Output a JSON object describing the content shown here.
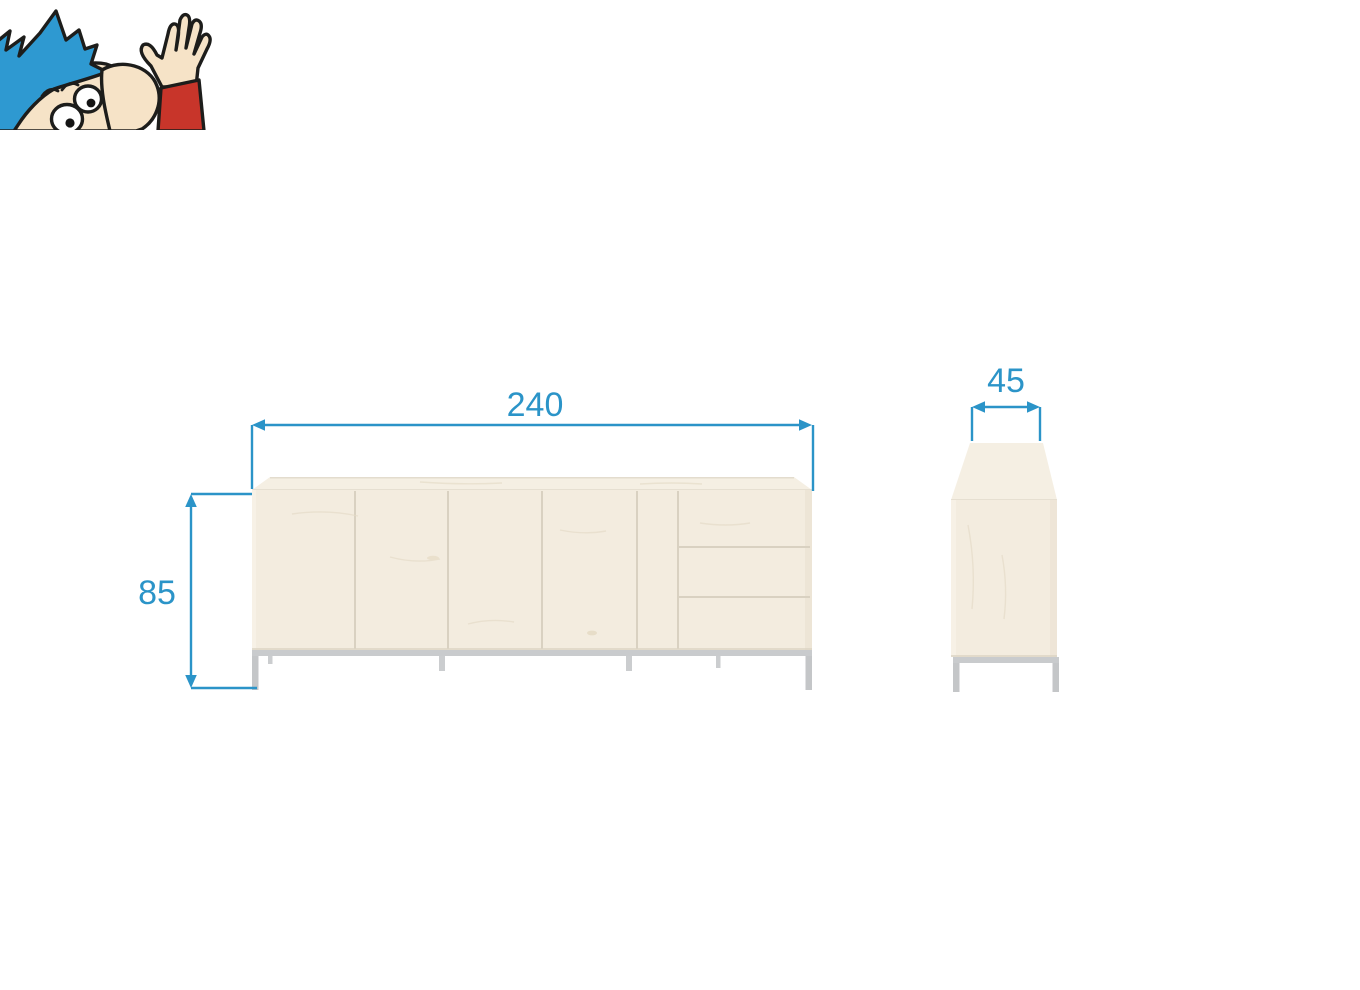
{
  "diagram": {
    "accent_color": "#2b94c8",
    "dimensions": {
      "width": "240",
      "height": "85",
      "depth": "45"
    },
    "front_view": {
      "doors": 4,
      "drawers": 3,
      "legs": 4
    },
    "side_view": {
      "legs": 2
    },
    "colors": {
      "wood_body": "#f3ecdf",
      "wood_top": "#f5efe3",
      "panel_gap": "#d9d1c1",
      "metal_frame": "#c4c6c8"
    }
  },
  "mascot": {
    "hair_color": "#2e99d1",
    "skin_color": "#f6e3c7",
    "sleeve_color": "#c8352a",
    "eye_color": "#ffffff",
    "pupil_color": "#141414",
    "outline_color": "#1d1d1b"
  }
}
